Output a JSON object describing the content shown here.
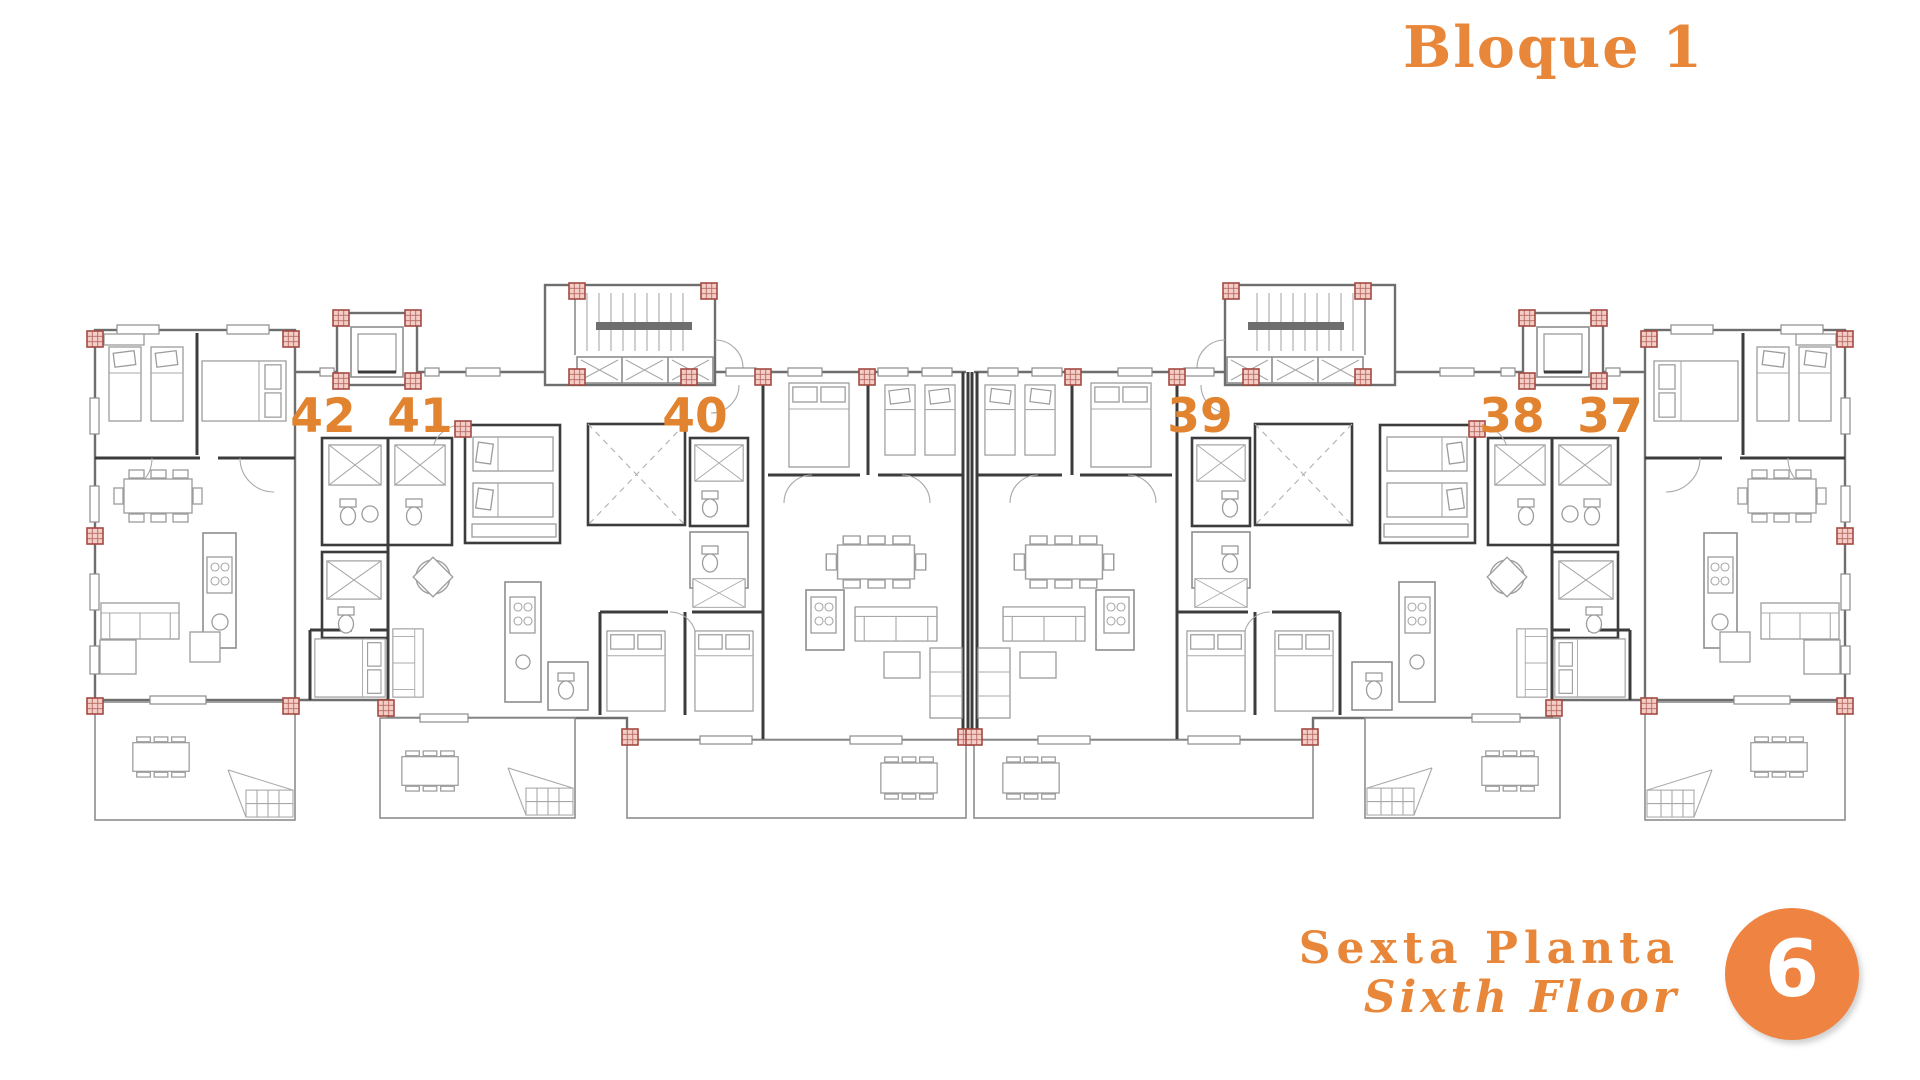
{
  "header": {
    "title": "Bloque 1"
  },
  "footer": {
    "floor_name_es": "Sexta Planta",
    "floor_name_en": "Sixth Floor",
    "floor_badge": "6"
  },
  "plan": {
    "unit_numbers": [
      "42",
      "41",
      "40",
      "39",
      "38",
      "37"
    ]
  },
  "colors": {
    "accent_orange": "#e8873a",
    "number_orange": "#e2832f",
    "badge_orange": "#ef8342",
    "marker_pink": "#f3cdc6",
    "marker_red": "#a34a42",
    "wall_dark": "#3c3c3c",
    "line_gray": "#8d8d8d",
    "background": "#ffffff"
  }
}
